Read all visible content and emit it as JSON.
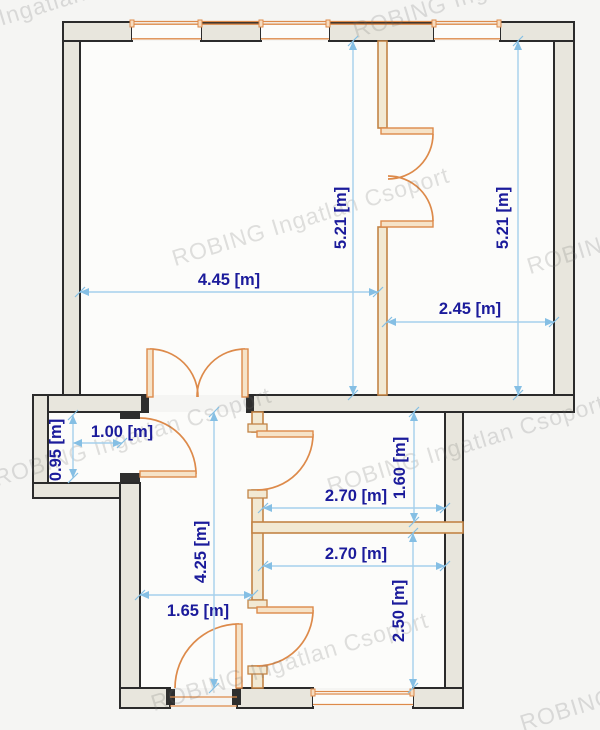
{
  "watermark": {
    "text": "ROBING Ingatlan Csoport"
  },
  "dims": {
    "left_room_height": "5.21 [m]",
    "right_room_height": "5.21 [m]",
    "left_room_width": "4.45 [m]",
    "right_room_width": "2.45 [m]",
    "niche_width": "1.00 [m]",
    "niche_depth": "0.95 [m]",
    "mid_room_depth": "1.60 [m]",
    "mid_room_width": "2.70 [m]",
    "lower_room_width": "2.70 [m]",
    "hallway_width": "1.65 [m]",
    "hallway_length": "4.25 [m]",
    "lower_room_depth": "2.50 [m]"
  },
  "colors": {
    "background": "#f5f5f3",
    "floor": "#fcfcfa",
    "wall_fill": "#e8e6dd",
    "wall_outline": "#2b2b2b",
    "partition_line": "#c28446",
    "door_window": "#dd8a4a",
    "dimension_line": "#a5d0ec",
    "dimension_text": "#1b1b9b",
    "watermark_text": "#d7d7d5"
  }
}
